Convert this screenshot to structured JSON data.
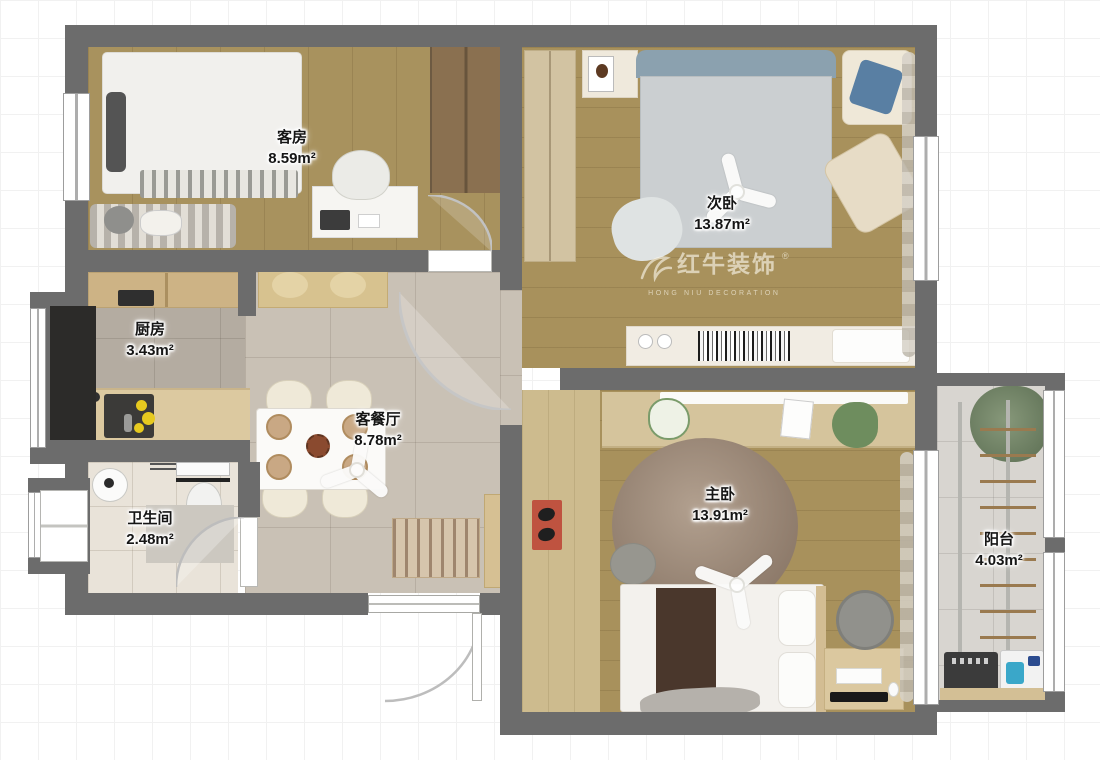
{
  "watermark": {
    "brand": "红牛装饰",
    "registered": "®",
    "subtitle": "HONG NIU DECORATION"
  },
  "rooms": [
    {
      "name": "客房",
      "area": "8.59m²"
    },
    {
      "name": "次卧",
      "area": "13.87m²"
    },
    {
      "name": "厨房",
      "area": "3.43m²"
    },
    {
      "name": "客餐厅",
      "area": "8.78m²"
    },
    {
      "name": "卫生间",
      "area": "2.48m²"
    },
    {
      "name": "主卧",
      "area": "13.91m²"
    },
    {
      "name": "阳台",
      "area": "4.03m²"
    }
  ],
  "palette": {
    "wall": "#6c6c6c",
    "wood_floor": "#a8915c",
    "corridor_floor": "#cdbb8e",
    "living_tile": "#c9c1b5",
    "kitchen_tile": "#b4aca1",
    "bath_tile": "#e9e3d9",
    "balcony_tile": "#d8d5d0",
    "door_mat_red": "#bf5340",
    "headboard_blue": "#8ba1af"
  }
}
